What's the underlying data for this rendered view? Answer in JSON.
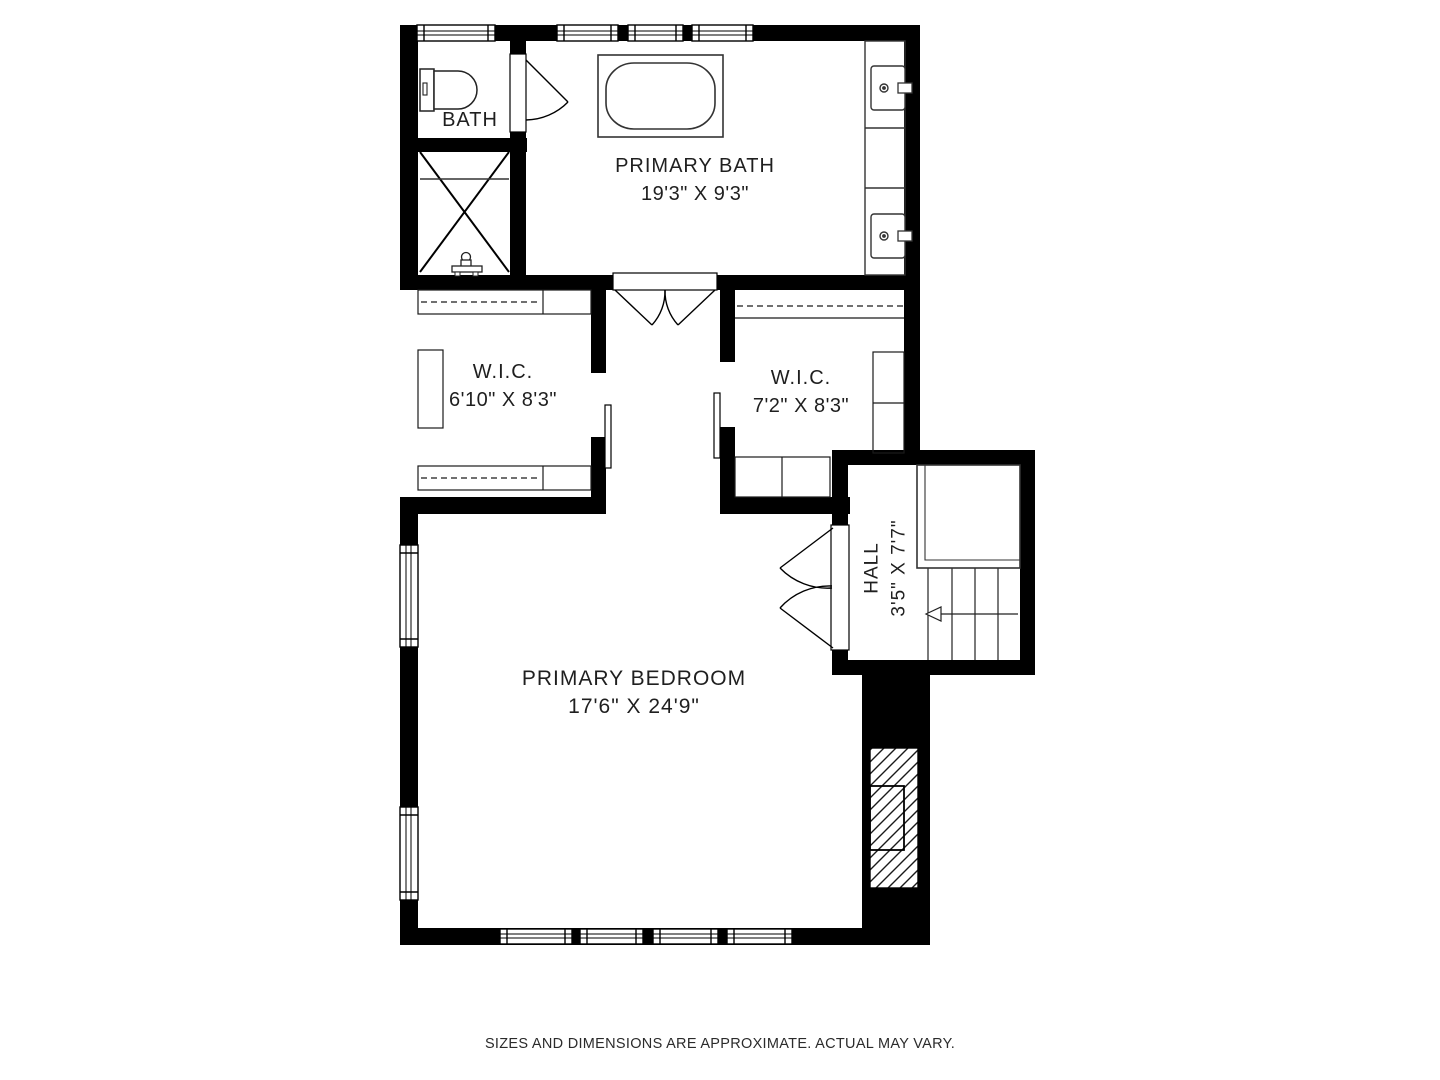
{
  "rooms": {
    "bath": {
      "name": "BATH"
    },
    "primary_bath": {
      "name": "PRIMARY BATH",
      "dimensions": "19'3\" X 9'3\""
    },
    "wic_left": {
      "name": "W.I.C.",
      "dimensions": "6'10\" X 8'3\""
    },
    "wic_right": {
      "name": "W.I.C.",
      "dimensions": "7'2\" X 8'3\""
    },
    "hall": {
      "name": "HALL",
      "dimensions": "3'5\" X 7'7\""
    },
    "primary_bedroom": {
      "name": "PRIMARY BEDROOM",
      "dimensions": "17'6\" X 24'9\""
    }
  },
  "footer": {
    "disclaimer": "SIZES AND DIMENSIONS ARE APPROXIMATE. ACTUAL MAY VARY."
  },
  "colors": {
    "wall": "#000000",
    "floor": "#ffffff",
    "line": "#333333"
  }
}
